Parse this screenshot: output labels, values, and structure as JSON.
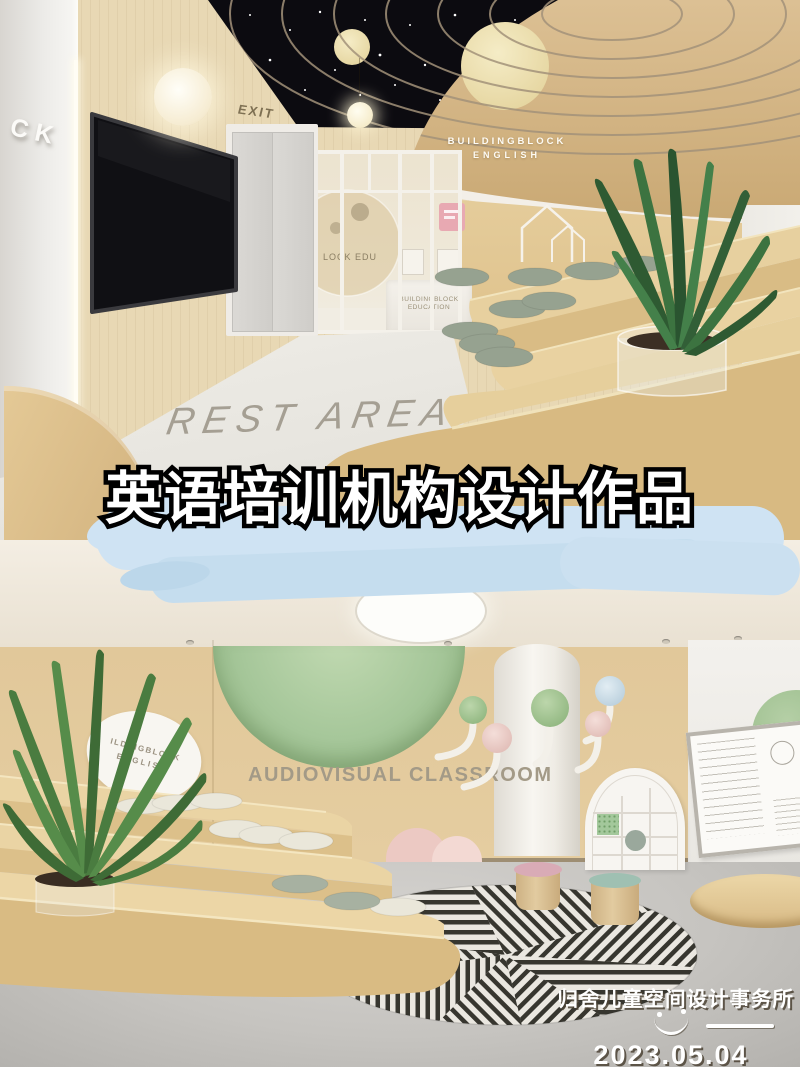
{
  "poster": {
    "title": "英语培训机构设计作品"
  },
  "rest_area": {
    "wall_letters": "CK",
    "exit_sign": "EXIT",
    "wall_logo_line1": "BUILDINGBLOCK",
    "wall_logo_line2": "ENGLISH",
    "glass_circle_text": "LOCK EDU",
    "desk_line1": "BUILDINGBLOCK",
    "desk_line2": "EDUCATION",
    "floor_text": "REST AREA"
  },
  "classroom": {
    "oval_sign_line1": "ILDINGBLOCK",
    "oval_sign_line2": "ENGLISH",
    "wall_text": "AUDIOVISUAL CLASSROOM"
  },
  "watermark": {
    "studio": "归舍儿童空间设计事务所",
    "date": "2023.05.04"
  },
  "colors": {
    "wood": "#dcc091",
    "ceiling_black": "#0c0b10",
    "planet_cream": "#eee1ae",
    "ring_gold": "#a3927a",
    "cloud": "#cfe3f3",
    "dome_green": "#a6c79a",
    "cushion_sage": "#96a290",
    "cushion_cream": "#eae7da",
    "stool_pink": "#d9abb6",
    "stool_teal": "#9fc0b2",
    "floor_gray": "#c6c4c0",
    "title_fill": "#ffffff",
    "title_stroke": "#000000"
  }
}
